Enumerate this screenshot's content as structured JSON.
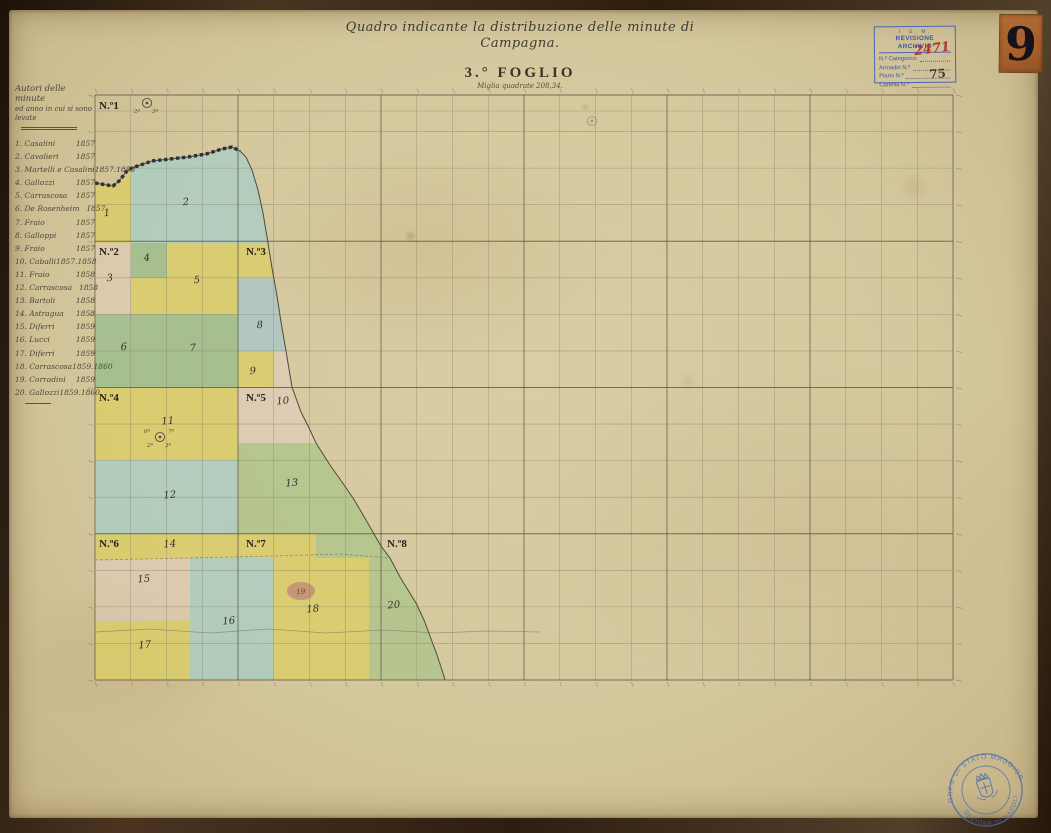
{
  "page": {
    "corner_number": "9"
  },
  "title_block": {
    "title": "Quadro indicante la distribuzione delle minute di Campagna.",
    "sheet": "3.° FOGLIO",
    "subtitle": "Miglia quadrate 208,34."
  },
  "archive_stamp": {
    "org": "I. G. M.",
    "heading": "REVISIONE ARCHIVIO",
    "rows": [
      {
        "label": "N.º Categorico"
      },
      {
        "label": "Armadio  N.º"
      },
      {
        "label": "Piano  N.º"
      },
      {
        "label": "Cartella  N.º"
      }
    ],
    "categorico_value": "2471",
    "cartella_value": "75"
  },
  "authors_panel": {
    "header_line1": "Autori delle minute",
    "header_line2": "ed anno in cui si sono levate",
    "entries": [
      {
        "num": "1.",
        "name": "Casalini",
        "years": "1857"
      },
      {
        "num": "2.",
        "name": "Cavalieri",
        "years": "1857"
      },
      {
        "num": "3.",
        "name": "Martelli e Casalini",
        "years": "1857.1858"
      },
      {
        "num": "4.",
        "name": "Gallozzi",
        "years": "1857"
      },
      {
        "num": "5.",
        "name": "Carrascosa",
        "years": "1857"
      },
      {
        "num": "6.",
        "name": "De Rosenheim",
        "years": "1857"
      },
      {
        "num": "7.",
        "name": "Fraio",
        "years": "1857"
      },
      {
        "num": "8.",
        "name": "Galloppi",
        "years": "1857"
      },
      {
        "num": "9.",
        "name": "Fraio",
        "years": "1857"
      },
      {
        "num": "10.",
        "name": "Caballi",
        "years": "1857.1858"
      },
      {
        "num": "11.",
        "name": "Fraio",
        "years": "1858"
      },
      {
        "num": "12.",
        "name": "Carrascosa",
        "years": "1858"
      },
      {
        "num": "13.",
        "name": "Bartoli",
        "years": "1858"
      },
      {
        "num": "14.",
        "name": "Astragua",
        "years": "1858"
      },
      {
        "num": "15.",
        "name": "Diferri",
        "years": "1859"
      },
      {
        "num": "16.",
        "name": "Lucci",
        "years": "1859"
      },
      {
        "num": "17.",
        "name": "Diferri",
        "years": "1859"
      },
      {
        "num": "18.",
        "name": "Carrascosa",
        "years": "1859.1860"
      },
      {
        "num": "19.",
        "name": "Corradini",
        "years": "1859"
      },
      {
        "num": "20.",
        "name": "Gallozzi",
        "years": "1859.1860"
      }
    ]
  },
  "seal": {
    "arc_top": "CORPO DI STATO MAGGIORE",
    "arc_bottom": "SEZIONE DI NAPOLI"
  },
  "map": {
    "grid": {
      "x": 95,
      "y": 95,
      "cols": 24,
      "rows": 16,
      "cellW": 35.75,
      "cellH": 36.5625,
      "majorEvery": 4,
      "extraTopLine": 111
    },
    "palette": {
      "yellow": "#dbcd66",
      "green": "#9cbd8b",
      "ygreen": "#afc48b",
      "teal": "#abcdc3",
      "blue": "#a3c6cf",
      "pink": "#e3cdc0",
      "blob": "#bd8f74",
      "ink": "#46423a",
      "gridMinor": "#837c68",
      "gridMajor": "#5f5a4a",
      "stamp_blue": "#4a69a8"
    },
    "coast": [
      [
        95,
        183
      ],
      [
        113,
        186
      ],
      [
        119,
        181
      ],
      [
        127,
        171
      ],
      [
        132,
        168
      ],
      [
        152,
        161
      ],
      [
        170,
        159
      ],
      [
        188,
        157
      ],
      [
        206,
        154
      ],
      [
        222,
        149
      ],
      [
        232,
        147
      ],
      [
        240,
        151
      ],
      [
        246,
        157
      ],
      [
        252,
        170
      ],
      [
        258,
        190
      ],
      [
        263,
        213
      ],
      [
        268,
        243
      ],
      [
        272,
        268
      ],
      [
        277,
        296
      ],
      [
        281,
        322
      ],
      [
        286,
        351
      ],
      [
        292,
        387
      ],
      [
        301,
        412
      ],
      [
        310,
        430
      ],
      [
        316,
        443
      ],
      [
        330,
        465
      ],
      [
        342,
        482
      ],
      [
        353,
        498
      ],
      [
        362,
        513
      ],
      [
        370,
        527
      ],
      [
        374,
        534
      ],
      [
        381,
        546
      ],
      [
        390,
        558
      ],
      [
        400,
        577
      ],
      [
        408,
        590
      ],
      [
        416,
        603
      ],
      [
        424,
        620
      ],
      [
        430,
        636
      ],
      [
        437,
        655
      ],
      [
        442,
        670
      ],
      [
        445,
        680
      ]
    ],
    "bead_points": 12,
    "regions": [
      {
        "n": "1",
        "color": "yellow",
        "poly": [
          [
            95,
            183
          ],
          [
            113,
            186
          ],
          [
            119,
            181
          ],
          [
            127,
            171
          ],
          [
            132,
            168
          ],
          [
            132,
            243
          ],
          [
            95,
            243
          ]
        ],
        "label": [
          107,
          216
        ]
      },
      {
        "n": "2",
        "color": "teal",
        "poly": [
          [
            132,
            168
          ],
          [
            152,
            161
          ],
          [
            170,
            159
          ],
          [
            188,
            157
          ],
          [
            206,
            154
          ],
          [
            222,
            149
          ],
          [
            232,
            147
          ],
          [
            240,
            151
          ],
          [
            246,
            157
          ],
          [
            252,
            170
          ],
          [
            258,
            190
          ],
          [
            263,
            213
          ],
          [
            268,
            243
          ],
          [
            132,
            243
          ]
        ],
        "label": [
          186,
          205
        ]
      },
      {
        "n": "3",
        "color": "pink",
        "rect": [
          95,
          243,
          36,
          108
        ],
        "op": 0.5,
        "label": [
          110,
          281
        ]
      },
      {
        "n": "4",
        "color": "green",
        "rect": [
          131,
          243,
          36,
          35
        ],
        "label": [
          147,
          261
        ]
      },
      {
        "n": "5",
        "color": "yellow",
        "poly": [
          [
            167,
            243
          ],
          [
            268,
            243
          ],
          [
            271,
            262
          ],
          [
            273,
            278
          ],
          [
            238,
            278
          ],
          [
            238,
            314
          ],
          [
            167,
            314
          ]
        ],
        "label": [
          197,
          283
        ]
      },
      {
        "n": "",
        "color": "yellow",
        "rect": [
          131,
          278,
          36,
          36
        ]
      },
      {
        "n": "8",
        "color": "blue",
        "poly": [
          [
            238,
            278
          ],
          [
            273,
            278
          ],
          [
            277,
            300
          ],
          [
            281,
            322
          ],
          [
            286,
            351
          ],
          [
            238,
            351
          ]
        ],
        "op": 0.7,
        "label": [
          260,
          328
        ]
      },
      {
        "n": "6",
        "color": "green",
        "rect": [
          95,
          314,
          72,
          73
        ],
        "label": [
          124,
          350
        ]
      },
      {
        "n": "7",
        "color": "green",
        "rect": [
          167,
          314,
          71,
          73
        ],
        "label": [
          193,
          351
        ]
      },
      {
        "n": "9",
        "color": "yellow",
        "rect": [
          238,
          351,
          36,
          36
        ],
        "label": [
          253,
          374
        ]
      },
      {
        "n": "",
        "color": "pink",
        "poly": [
          [
            274,
            351
          ],
          [
            286,
            351
          ],
          [
            292,
            387
          ],
          [
            274,
            387
          ]
        ],
        "op": 0.5
      },
      {
        "n": "10",
        "color": "pink",
        "poly": [
          [
            238,
            387
          ],
          [
            292,
            387
          ],
          [
            301,
            412
          ],
          [
            310,
            430
          ],
          [
            316,
            443
          ],
          [
            238,
            443
          ]
        ],
        "op": 0.6,
        "label": [
          283,
          404
        ]
      },
      {
        "n": "11",
        "color": "yellow",
        "rect": [
          95,
          387,
          143,
          73
        ],
        "label": [
          168,
          424
        ]
      },
      {
        "n": "12",
        "color": "teal",
        "rect": [
          95,
          460,
          143,
          74
        ],
        "label": [
          170,
          498
        ]
      },
      {
        "n": "13",
        "color": "ygreen",
        "poly": [
          [
            238,
            443
          ],
          [
            316,
            443
          ],
          [
            330,
            465
          ],
          [
            342,
            482
          ],
          [
            353,
            498
          ],
          [
            362,
            513
          ],
          [
            370,
            527
          ],
          [
            374,
            534
          ],
          [
            238,
            534
          ]
        ],
        "label": [
          292,
          486
        ]
      },
      {
        "n": "14",
        "color": "yellow",
        "poly": [
          [
            95,
            534
          ],
          [
            316,
            534
          ],
          [
            316,
            558
          ],
          [
            95,
            560
          ]
        ],
        "label": [
          170,
          547
        ]
      },
      {
        "n": "",
        "color": "ygreen",
        "poly": [
          [
            316,
            534
          ],
          [
            374,
            534
          ],
          [
            381,
            546
          ],
          [
            390,
            558
          ],
          [
            316,
            558
          ]
        ]
      },
      {
        "n": "15",
        "color": "pink",
        "poly": [
          [
            95,
            560
          ],
          [
            190,
            558
          ],
          [
            190,
            620
          ],
          [
            95,
            622
          ]
        ],
        "op": 0.55,
        "label": [
          144,
          582
        ]
      },
      {
        "n": "16",
        "color": "teal",
        "rect": [
          190,
          558,
          84,
          122
        ],
        "label": [
          229,
          624
        ]
      },
      {
        "n": "17",
        "color": "yellow",
        "poly": [
          [
            95,
            622
          ],
          [
            190,
            620
          ],
          [
            190,
            680
          ],
          [
            95,
            680
          ]
        ],
        "label": [
          145,
          648
        ]
      },
      {
        "n": "18",
        "color": "yellow",
        "rect": [
          274,
          558,
          95,
          122
        ],
        "label": [
          313,
          612
        ]
      },
      {
        "n": "20",
        "color": "ygreen",
        "poly": [
          [
            369,
            558
          ],
          [
            390,
            558
          ],
          [
            400,
            577
          ],
          [
            408,
            590
          ],
          [
            416,
            603
          ],
          [
            424,
            620
          ],
          [
            430,
            636
          ],
          [
            437,
            655
          ],
          [
            442,
            670
          ],
          [
            445,
            680
          ],
          [
            369,
            680
          ]
        ],
        "label": [
          394,
          608
        ]
      },
      {
        "n": "19",
        "color": "blob",
        "ellipse": [
          301,
          591,
          14,
          9
        ],
        "op": 0.85,
        "label": [
          301,
          594
        ],
        "labelColor": "#6e3a28",
        "labelSize": 7
      }
    ],
    "sheets": [
      {
        "label": "N.º1",
        "x": 99,
        "y": 109
      },
      {
        "label": "N.º2",
        "x": 99,
        "y": 255
      },
      {
        "label": "N.º3",
        "x": 246,
        "y": 255
      },
      {
        "label": "N.º4",
        "x": 99,
        "y": 401
      },
      {
        "label": "N.º5",
        "x": 246,
        "y": 401
      },
      {
        "label": "N.º6",
        "x": 99,
        "y": 547
      },
      {
        "label": "N.º7",
        "x": 246,
        "y": 547
      },
      {
        "label": "N.º8",
        "x": 387,
        "y": 547
      }
    ],
    "symbols": [
      {
        "x": 147,
        "y": 103,
        "marks": [
          "2ª",
          "3ª"
        ]
      },
      {
        "x": 160,
        "y": 437,
        "marks": [
          "2ª",
          "3ª",
          "6ª",
          "7ª"
        ]
      },
      {
        "x": 592,
        "y": 121,
        "marks": []
      }
    ],
    "boundary_dashed": [
      [
        95,
        560
      ],
      [
        190,
        558
      ],
      [
        274,
        556
      ],
      [
        340,
        554
      ],
      [
        390,
        558
      ]
    ],
    "river": [
      [
        95,
        632
      ],
      [
        150,
        629
      ],
      [
        210,
        633
      ],
      [
        268,
        629
      ],
      [
        326,
        633
      ],
      [
        384,
        630
      ],
      [
        436,
        633
      ],
      [
        488,
        631
      ],
      [
        540,
        632
      ]
    ]
  }
}
